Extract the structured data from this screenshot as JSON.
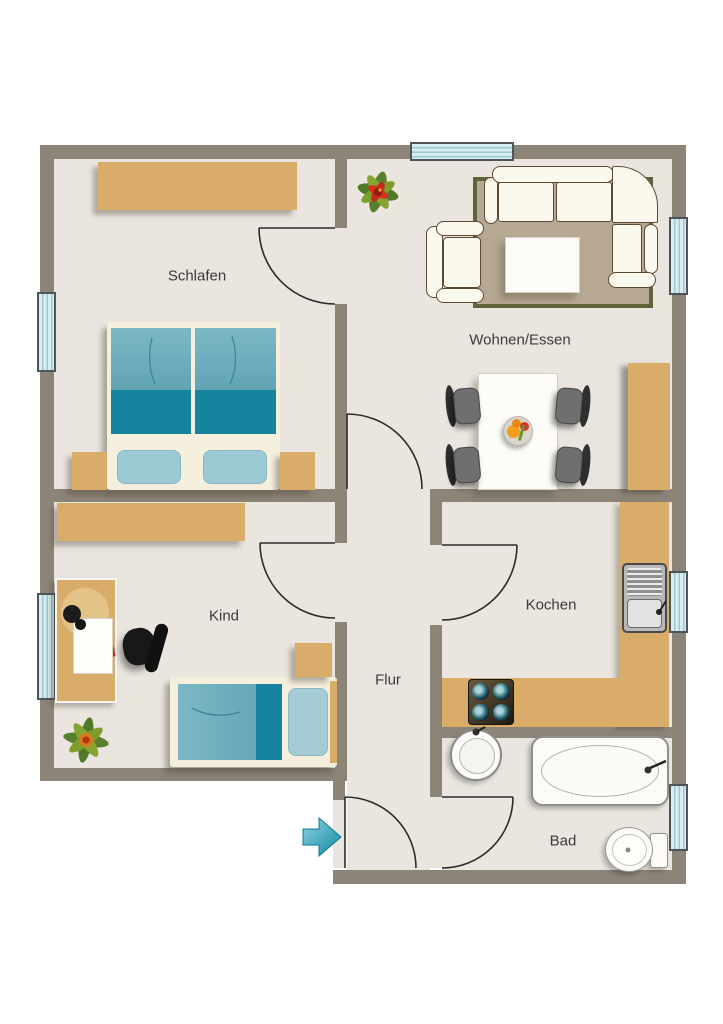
{
  "plan": {
    "title": "Apartment floor plan",
    "rooms": [
      {
        "id": "schlafen",
        "label": "Schlafen",
        "furniture": [
          "wardrobe",
          "double-bed",
          "nightstand-left",
          "nightstand-right",
          "window"
        ]
      },
      {
        "id": "wohnen-essen",
        "label": "Wohnen/Essen",
        "furniture": [
          "corner-sofa",
          "armchair",
          "coffee-table",
          "rug",
          "plant",
          "dining-table",
          "four-chairs",
          "fruit-bowl",
          "sideboard",
          "window-top",
          "window-right"
        ]
      },
      {
        "id": "kind",
        "label": "Kind",
        "furniture": [
          "wardrobe",
          "desk",
          "desk-lamp",
          "desk-chair",
          "single-bed",
          "nightstand",
          "plant",
          "window"
        ]
      },
      {
        "id": "kochen",
        "label": "Kochen",
        "furniture": [
          "l-shaped-counter",
          "sink",
          "stove",
          "window"
        ]
      },
      {
        "id": "flur",
        "label": "Flur",
        "furniture": []
      },
      {
        "id": "bad",
        "label": "Bad",
        "furniture": [
          "washbasin",
          "bathtub",
          "toilet",
          "window"
        ]
      }
    ],
    "entrance": {
      "indicator": "arrow",
      "direction": "right"
    },
    "doors": [
      "schlafen",
      "wohnen-essen",
      "kind",
      "kochen",
      "bad",
      "entrance"
    ],
    "colors": {
      "wall": "#8d8478",
      "floor": "#eae6df",
      "wood": "#d9ad69",
      "bed-blue": "#69abb9",
      "bed-teal": "#16849f",
      "rug": "#b7a891",
      "rug-border": "#60633a",
      "door-line": "#2b2b28",
      "window-fill": "#d7edf2",
      "window-line": "#9cc6d0",
      "arrow": "#2aa2ba",
      "label-text": "#3b3b3b",
      "sofa-fill": "#fbf8ee",
      "sofa-outline": "#5d4a33"
    }
  }
}
